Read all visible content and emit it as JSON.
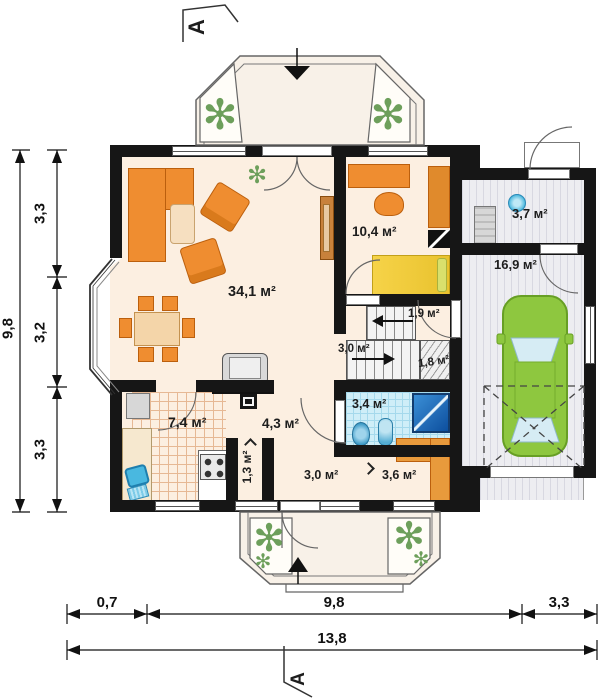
{
  "title": "Floor plan — ground floor",
  "section_markers": {
    "top": "A",
    "bottom": "A"
  },
  "dimensions": {
    "left": {
      "segments": [
        "3,3",
        "3,2",
        "3,3"
      ],
      "total": "9,8"
    },
    "bottom": {
      "segments": [
        "0,7",
        "9,8",
        "3,3"
      ],
      "total": "13,8"
    }
  },
  "rooms": {
    "living": {
      "area": "34,1 м²"
    },
    "bedroom": {
      "area": "10,4 м²"
    },
    "utility": {
      "area": "3,7 м²"
    },
    "garage": {
      "area": "16,9 м²"
    },
    "hall_upper": {
      "area": "1,9 м²"
    },
    "stairs": {
      "area": "3,0 м²"
    },
    "under_stairs": {
      "area": "1,8 м²"
    },
    "bathroom": {
      "area": "3,4 м²"
    },
    "kitchen": {
      "area": "7,4 м²"
    },
    "hall": {
      "area": "4,3 м²"
    },
    "pantry": {
      "area": "1,3 м²"
    },
    "hall_lower": {
      "area": "3,0 м²"
    },
    "wardrobe": {
      "area": "3,6 м²"
    }
  },
  "icons": {
    "plant": "✻"
  },
  "colors": {
    "wall": "#161616",
    "floor": "#fcefe1",
    "furniture_orange": "#ef8d30",
    "bed_yellow": "#f6d348",
    "car_green": "#8ec73f",
    "bath_tile_blue": "#cfeef8",
    "shower_blue": "#1f6fc0",
    "garage_floor": "#ededf1",
    "plant_green": "#6d9f5b"
  }
}
